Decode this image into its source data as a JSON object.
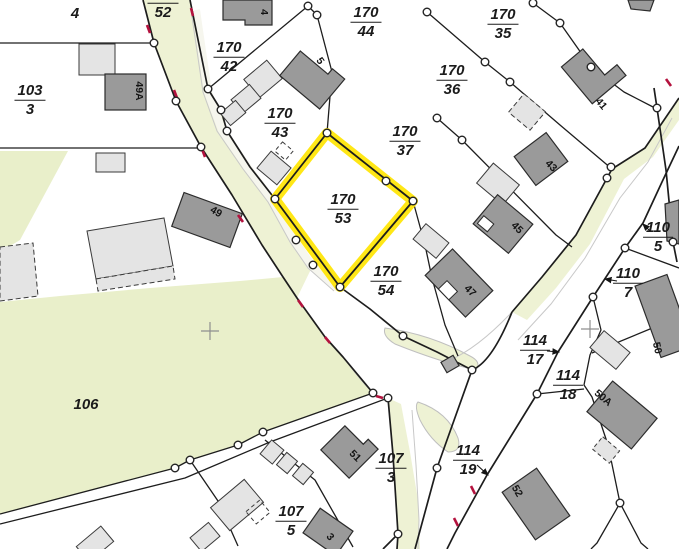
{
  "map": {
    "title": "Cadastral parcel map",
    "highlighted_parcel": "170/53",
    "colors": {
      "highlight_yellow": "#ffe60a",
      "road_fill": "#eef2d4",
      "meadow_fill": "#e9efca",
      "building_dark": "#9a9a9a",
      "building_light": "#e4e4e4",
      "boundary_line": "#1d1d1d",
      "red_tick": "#b4123e",
      "kerb_gray": "#c8c8c8"
    },
    "parcel_labels": [
      {
        "id": "4",
        "num": "4",
        "x": 75,
        "y": 14
      },
      {
        "id": "170/52",
        "num": "170",
        "den": "52",
        "x": 163,
        "y": 3
      },
      {
        "id": "170/42",
        "num": "170",
        "den": "42",
        "x": 229,
        "y": 57
      },
      {
        "id": "170/43",
        "num": "170",
        "den": "43",
        "x": 280,
        "y": 123
      },
      {
        "id": "170/44",
        "num": "170",
        "den": "44",
        "x": 366,
        "y": 22
      },
      {
        "id": "170/35",
        "num": "170",
        "den": "35",
        "x": 503,
        "y": 24
      },
      {
        "id": "170/36",
        "num": "170",
        "den": "36",
        "x": 452,
        "y": 80
      },
      {
        "id": "170/37",
        "num": "170",
        "den": "37",
        "x": 405,
        "y": 141
      },
      {
        "id": "170/53",
        "num": "170",
        "den": "53",
        "x": 343,
        "y": 209,
        "highlight": true
      },
      {
        "id": "170/54",
        "num": "170",
        "den": "54",
        "x": 386,
        "y": 281
      },
      {
        "id": "103/3",
        "num": "103",
        "den": "3",
        "x": 30,
        "y": 100
      },
      {
        "id": "106",
        "num": "106",
        "x": 86,
        "y": 405
      },
      {
        "id": "107/3",
        "num": "107",
        "den": "3",
        "x": 391,
        "y": 468
      },
      {
        "id": "107/5",
        "num": "107",
        "den": "5",
        "x": 291,
        "y": 521
      },
      {
        "id": "110/5",
        "num": "110",
        "den": "5",
        "x": 658,
        "y": 237
      },
      {
        "id": "110/7",
        "num": "110",
        "den": "7",
        "x": 628,
        "y": 283
      },
      {
        "id": "114/17",
        "num": "114",
        "den": "17",
        "x": 535,
        "y": 350
      },
      {
        "id": "114/18",
        "num": "114",
        "den": "18",
        "x": 568,
        "y": 385
      },
      {
        "id": "114/19",
        "num": "114",
        "den": "19",
        "x": 468,
        "y": 460
      }
    ],
    "building_labels": [
      {
        "text": "4",
        "x": 264,
        "y": 12,
        "rot": 90
      },
      {
        "text": "5",
        "x": 320,
        "y": 61,
        "rot": 55
      },
      {
        "text": "49A",
        "x": 139,
        "y": 91,
        "rot": 90
      },
      {
        "text": "41",
        "x": 601,
        "y": 104,
        "rot": 50
      },
      {
        "text": "43",
        "x": 551,
        "y": 166,
        "rot": 45
      },
      {
        "text": "45",
        "x": 517,
        "y": 228,
        "rot": 45
      },
      {
        "text": "47",
        "x": 470,
        "y": 291,
        "rot": 45
      },
      {
        "text": "49",
        "x": 216,
        "y": 212,
        "rot": 30
      },
      {
        "text": "50",
        "x": 657,
        "y": 348,
        "rot": 78
      },
      {
        "text": "50A",
        "x": 603,
        "y": 398,
        "rot": 40
      },
      {
        "text": "51",
        "x": 355,
        "y": 456,
        "rot": 45
      },
      {
        "text": "52",
        "x": 517,
        "y": 491,
        "rot": 60
      },
      {
        "text": "3",
        "x": 330,
        "y": 537,
        "rot": 50
      }
    ]
  }
}
